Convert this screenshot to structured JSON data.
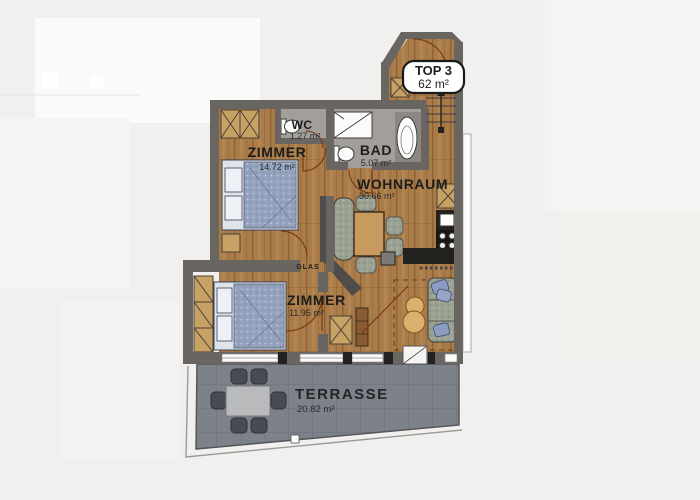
{
  "palette": {
    "bg": "#f1f0ee",
    "wall": "#696561",
    "wood": "#a97c4a",
    "wood_dark": "#8f6233",
    "wood_light": "#b98c58",
    "bath_floor": "#a29f9b",
    "terrace": "#7d818a",
    "terrace_line": "#6d7078",
    "bed": "#93a2bd",
    "fabric": "#9aa092",
    "table_wood": "#c99a5f",
    "counter": "#23211d",
    "wardrobe": "#c8a264",
    "door_line": "#7a3a12",
    "lounge_chair": "#d9b06c",
    "terrace_chair": "#474b55",
    "ink": "#1d1d1d"
  },
  "unit": {
    "name": "TOP 3",
    "area": "62 m²"
  },
  "rooms": {
    "wc": {
      "name": "WC",
      "area": "1.27 m²"
    },
    "zimmer1": {
      "name": "ZIMMER",
      "area": "14.72 m²"
    },
    "bad": {
      "name": "BAD",
      "area": "5.07 m²"
    },
    "wohnraum": {
      "name": "WOHNRAUM",
      "area": "30.66 m²"
    },
    "zimmer2": {
      "name": "ZIMMER",
      "area": "11.95 m²"
    },
    "terrasse": {
      "name": "TERRASSE",
      "area": "20.82 m²"
    }
  },
  "annotations": {
    "glas": "GLAS"
  }
}
